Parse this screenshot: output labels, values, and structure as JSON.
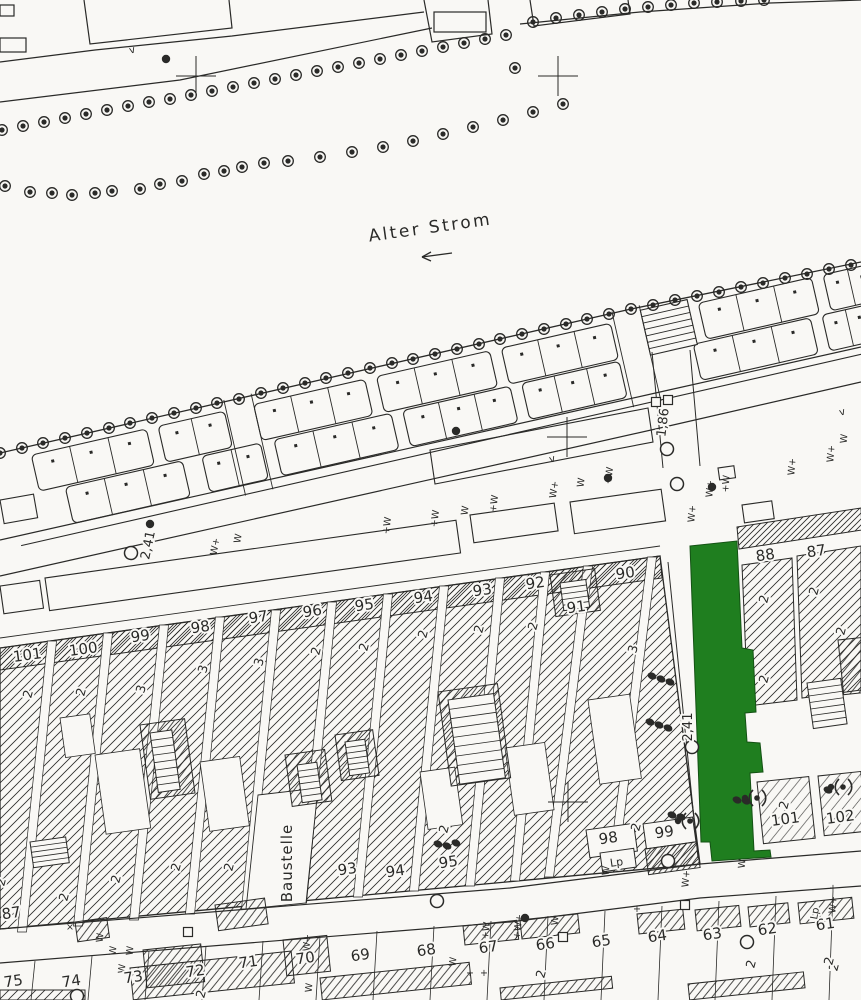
{
  "map": {
    "type": "cadastral-scan",
    "colors": {
      "paper": "#f9f8f5",
      "ink": "#2a2a28",
      "highlight_green": "#1f7e1f",
      "highlight_border": "#145214"
    },
    "labels": {
      "alter_strom": {
        "text": "Alter Strom",
        "x": 431,
        "y": 233,
        "rot": -8,
        "size": 17,
        "spacing": 2.5
      },
      "baustelle": {
        "text": "Baustelle",
        "x": 292,
        "y": 863,
        "rot": -90,
        "size": 15,
        "spacing": 1
      },
      "m241_left": {
        "text": "2,41",
        "x": 152,
        "y": 546,
        "rot": -78,
        "size": 13,
        "spacing": 0
      },
      "m241_right": {
        "text": "2,41",
        "x": 692,
        "y": 727,
        "rot": -90,
        "size": 13,
        "spacing": 0
      },
      "m186": {
        "text": "1,86",
        "x": 667,
        "y": 423,
        "rot": -83,
        "size": 13,
        "spacing": 0
      },
      "lp_block": {
        "text": "Lp",
        "x": 617,
        "y": 866,
        "rot": -8,
        "size": 11,
        "spacing": 0
      },
      "lp_right": {
        "text": "Lp",
        "x": 818,
        "y": 914,
        "rot": -80,
        "size": 10,
        "spacing": 0
      }
    },
    "arrow": {
      "x1": 452,
      "y1": 253,
      "x2": 422,
      "y2": 257
    },
    "parcels_top": [
      [
        "101",
        28,
        660
      ],
      [
        "100",
        84,
        654
      ],
      [
        "99",
        141,
        641
      ],
      [
        "98",
        201,
        632
      ],
      [
        "97",
        259,
        622
      ],
      [
        "96",
        313,
        616
      ],
      [
        "95",
        365,
        610
      ],
      [
        "94",
        424,
        602
      ],
      [
        "93",
        483,
        595
      ],
      [
        "92",
        536,
        588
      ],
      [
        "91",
        577,
        612
      ],
      [
        "90",
        626,
        578
      ]
    ],
    "parcels_right": [
      [
        "88",
        766,
        560
      ],
      [
        "87",
        817,
        556
      ]
    ],
    "parcels_inner": [
      [
        "93",
        348,
        874
      ],
      [
        "94",
        396,
        876
      ],
      [
        "95",
        449,
        867
      ],
      [
        "98",
        609,
        843
      ],
      [
        "99",
        665,
        837
      ],
      [
        "101",
        786,
        824
      ],
      [
        "102",
        841,
        822
      ]
    ],
    "parcels_bottom": [
      [
        "75",
        14,
        986
      ],
      [
        "74",
        72,
        986
      ],
      [
        "73",
        134,
        982
      ],
      [
        "72",
        196,
        976
      ],
      [
        "71",
        249,
        967
      ],
      [
        "70",
        306,
        963
      ],
      [
        "69",
        361,
        960
      ],
      [
        "68",
        427,
        955
      ],
      [
        "67",
        489,
        952
      ],
      [
        "66",
        546,
        949
      ],
      [
        "65",
        602,
        946
      ],
      [
        "64",
        658,
        941
      ],
      [
        "63",
        713,
        939
      ],
      [
        "62",
        768,
        934
      ],
      [
        "61",
        826,
        929
      ],
      [
        "87",
        12,
        918
      ]
    ],
    "story_marks": [
      [
        "2",
        32,
        695
      ],
      [
        "2",
        85,
        693
      ],
      [
        "3",
        145,
        690
      ],
      [
        "3",
        207,
        670
      ],
      [
        "3",
        263,
        663
      ],
      [
        "2",
        320,
        652
      ],
      [
        "2",
        368,
        648
      ],
      [
        "2",
        427,
        635
      ],
      [
        "2",
        483,
        630
      ],
      [
        "2",
        537,
        627
      ],
      [
        "3",
        637,
        650
      ],
      [
        "2",
        768,
        600
      ],
      [
        "2",
        818,
        592
      ],
      [
        "2",
        768,
        680
      ],
      [
        "2",
        845,
        632
      ],
      [
        "2",
        788,
        806
      ],
      [
        "2",
        640,
        828
      ],
      [
        "2",
        448,
        830
      ],
      [
        "2",
        233,
        868
      ],
      [
        "2",
        180,
        868
      ],
      [
        "2",
        120,
        880
      ],
      [
        "2",
        68,
        898
      ],
      [
        "2",
        5,
        883
      ],
      [
        "2",
        545,
        975
      ],
      [
        "2",
        755,
        965
      ],
      [
        "2",
        838,
        968
      ],
      [
        "2",
        205,
        995
      ],
      [
        "2",
        833,
        962
      ]
    ],
    "utility_marks": [
      [
        "W+",
        218,
        547,
        -80
      ],
      [
        "W",
        241,
        539,
        -80
      ],
      [
        "+W",
        390,
        526,
        -82
      ],
      [
        "+W",
        438,
        519,
        -82
      ],
      [
        "W",
        468,
        511,
        -82
      ],
      [
        "+W",
        497,
        504,
        -82
      ],
      [
        "W+",
        557,
        490,
        -82
      ],
      [
        "W",
        584,
        483,
        -82
      ],
      [
        "+W",
        612,
        476,
        -82
      ],
      [
        "W+",
        695,
        514,
        -85
      ],
      [
        "W+",
        713,
        489,
        -85
      ],
      [
        "+W",
        729,
        484,
        -85
      ],
      [
        "W+",
        795,
        467,
        -85
      ],
      [
        "W+",
        834,
        454,
        -85
      ],
      [
        "W",
        847,
        439,
        -85
      ],
      [
        "W",
        116,
        951,
        -85
      ],
      [
        "W",
        133,
        951,
        -85
      ],
      [
        "W",
        125,
        969,
        -85
      ],
      [
        "W+",
        310,
        943,
        -85
      ],
      [
        "+W",
        489,
        931,
        -82
      ],
      [
        "+W+",
        521,
        927,
        -82
      ],
      [
        "W",
        558,
        921,
        -85
      ],
      [
        "+",
        637,
        912,
        0
      ],
      [
        "W+",
        836,
        905,
        -85
      ],
      [
        "+",
        833,
        891,
        0
      ],
      [
        "W",
        456,
        962,
        -85
      ],
      [
        "+",
        470,
        976,
        0
      ],
      [
        "+",
        484,
        976,
        0
      ],
      [
        "W",
        312,
        988,
        -85
      ],
      [
        "W+",
        689,
        879,
        -85
      ],
      [
        "W",
        609,
        871,
        -85
      ],
      [
        "×",
        70,
        930,
        0
      ],
      [
        "W",
        745,
        864,
        -85
      ],
      [
        "W",
        103,
        938,
        -85
      ]
    ],
    "v_marks": [
      [
        133,
        53
      ],
      [
        843,
        415
      ],
      [
        553,
        462
      ]
    ],
    "tree_rows": {
      "upper_row": [
        [
          2,
          130
        ],
        [
          23,
          126
        ],
        [
          44,
          122
        ],
        [
          65,
          118
        ],
        [
          86,
          114
        ],
        [
          107,
          110
        ],
        [
          128,
          106
        ],
        [
          149,
          102
        ],
        [
          170,
          99
        ],
        [
          191,
          95
        ],
        [
          212,
          91
        ],
        [
          233,
          87
        ],
        [
          254,
          83
        ],
        [
          275,
          79
        ],
        [
          296,
          75
        ],
        [
          317,
          71
        ],
        [
          338,
          67
        ],
        [
          359,
          63
        ],
        [
          380,
          59
        ],
        [
          401,
          55
        ],
        [
          422,
          51
        ],
        [
          443,
          47
        ],
        [
          464,
          43
        ],
        [
          485,
          39
        ],
        [
          506,
          35
        ]
      ],
      "top_right_row": [
        [
          533,
          22
        ],
        [
          556,
          18
        ],
        [
          579,
          15
        ],
        [
          602,
          12
        ],
        [
          625,
          9
        ],
        [
          648,
          7
        ],
        [
          671,
          5
        ],
        [
          694,
          3
        ],
        [
          717,
          2
        ],
        [
          741,
          1
        ],
        [
          764,
          0
        ]
      ],
      "scattered_row": [
        [
          5,
          186
        ],
        [
          30,
          192
        ],
        [
          52,
          193
        ],
        [
          72,
          195
        ],
        [
          95,
          193
        ],
        [
          112,
          191
        ],
        [
          140,
          189
        ],
        [
          160,
          184
        ],
        [
          182,
          181
        ],
        [
          204,
          174
        ],
        [
          224,
          171
        ],
        [
          242,
          167
        ],
        [
          264,
          163
        ],
        [
          288,
          161
        ],
        [
          320,
          157
        ],
        [
          352,
          152
        ],
        [
          383,
          147
        ],
        [
          413,
          141
        ],
        [
          443,
          134
        ],
        [
          473,
          127
        ],
        [
          503,
          120
        ],
        [
          533,
          112
        ],
        [
          563,
          104
        ]
      ],
      "quay_row": [
        [
          0,
          453
        ],
        [
          22,
          448
        ],
        [
          43,
          443
        ],
        [
          65,
          438
        ],
        [
          87,
          433
        ],
        [
          109,
          428
        ],
        [
          130,
          423
        ],
        [
          152,
          418
        ],
        [
          174,
          413
        ],
        [
          196,
          408
        ],
        [
          217,
          403
        ],
        [
          239,
          399
        ],
        [
          261,
          393
        ],
        [
          283,
          388
        ],
        [
          305,
          383
        ],
        [
          326,
          378
        ],
        [
          348,
          373
        ],
        [
          370,
          368
        ],
        [
          392,
          363
        ],
        [
          413,
          359
        ],
        [
          435,
          354
        ],
        [
          457,
          349
        ],
        [
          479,
          344
        ],
        [
          500,
          339
        ],
        [
          522,
          334
        ],
        [
          544,
          329
        ],
        [
          566,
          324
        ],
        [
          587,
          319
        ],
        [
          609,
          314
        ],
        [
          631,
          309
        ],
        [
          653,
          305
        ],
        [
          675,
          300
        ],
        [
          697,
          296
        ],
        [
          719,
          292
        ],
        [
          741,
          287
        ],
        [
          763,
          283
        ],
        [
          785,
          278
        ],
        [
          807,
          274
        ],
        [
          829,
          269
        ],
        [
          851,
          265
        ]
      ],
      "isolated": [
        [
          515,
          68
        ]
      ]
    },
    "stalls": {
      "angle": -12.83,
      "cx": 0,
      "cy": 453,
      "rows": [
        {
          "y": 462,
          "h": 37,
          "groups": [
            [
              30,
              148,
              3
            ],
            [
              160,
              228,
              2
            ],
            [
              258,
              372,
              3
            ],
            [
              384,
              500,
              3
            ],
            [
              512,
              624,
              3
            ],
            [
              714,
              830,
              3
            ],
            [
              842,
              892,
              2
            ]
          ]
        },
        {
          "y": 501,
          "h": 37,
          "groups": [
            [
              56,
              176,
              3
            ],
            [
              196,
              256,
              2
            ],
            [
              270,
              390,
              3
            ],
            [
              402,
              512,
              3
            ],
            [
              524,
              624,
              3
            ],
            [
              700,
              820,
              3
            ],
            [
              832,
              880,
              2
            ]
          ]
        }
      ],
      "steps": {
        "x": 656,
        "y": 456,
        "w": 48,
        "h": 46,
        "rungs": 6
      },
      "lanes": [
        [
          230,
          258
        ],
        [
          628,
          656
        ]
      ],
      "bottom_line_y": 548
    },
    "stairs": [
      [
        150,
        733,
        22,
        60,
        7
      ],
      [
        297,
        765,
        20,
        38,
        5
      ],
      [
        345,
        742,
        20,
        34,
        5
      ],
      [
        448,
        700,
        46,
        85,
        8
      ],
      [
        560,
        583,
        26,
        28,
        4
      ],
      [
        807,
        683,
        34,
        46,
        6
      ],
      [
        30,
        842,
        36,
        26,
        4
      ]
    ],
    "survey": {
      "crosses": [
        [
          196,
          76
        ],
        [
          558,
          76
        ],
        [
          567,
          437
        ],
        [
          568,
          802
        ]
      ],
      "circles": [
        [
          131,
          553
        ],
        [
          667,
          449
        ],
        [
          677,
          484
        ],
        [
          692,
          747
        ],
        [
          437,
          901
        ],
        [
          747,
          942
        ],
        [
          77,
          996
        ],
        [
          668,
          861
        ]
      ],
      "dots": [
        [
          150,
          524
        ],
        [
          456,
          431
        ],
        [
          166,
          59
        ],
        [
          608,
          478
        ],
        [
          712,
          487
        ],
        [
          525,
          918
        ]
      ],
      "squares": [
        [
          656,
          402
        ],
        [
          668,
          400
        ],
        [
          563,
          937
        ],
        [
          188,
          932
        ],
        [
          685,
          905
        ]
      ]
    },
    "vegetation": {
      "dot_clusters": [
        [
          [
            652,
            676
          ],
          [
            661,
            679
          ],
          [
            670,
            682
          ]
        ],
        [
          [
            650,
            722
          ],
          [
            659,
            725
          ],
          [
            668,
            728
          ]
        ],
        [
          [
            438,
            844
          ],
          [
            447,
            846
          ],
          [
            456,
            843
          ]
        ],
        [
          [
            737,
            800
          ],
          [
            746,
            801
          ]
        ],
        [
          [
            828,
            790
          ]
        ],
        [
          [
            672,
            815
          ],
          [
            681,
            817
          ]
        ]
      ],
      "shrubs": [
        [
          757,
          798
        ],
        [
          843,
          787
        ],
        [
          690,
          821
        ]
      ]
    }
  }
}
